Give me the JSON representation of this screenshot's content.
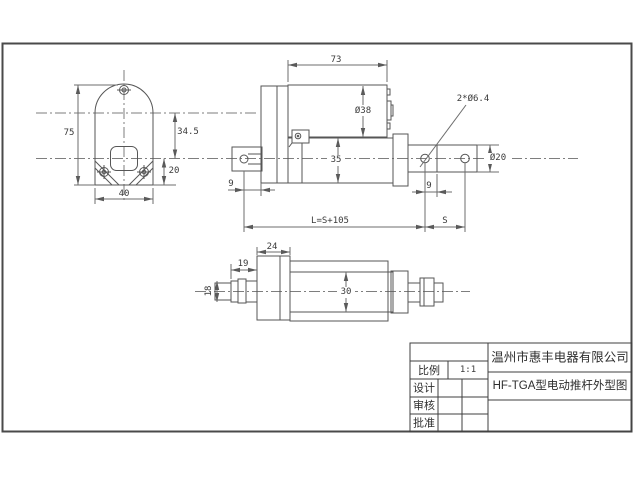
{
  "drawing": {
    "views": {
      "side_view": {
        "dims": {
          "overall_height": "75",
          "arc_center_to_axis": "34.5",
          "axis_to_bottom": "20",
          "width": "40"
        }
      },
      "front_view": {
        "dims": {
          "motor_length": "73",
          "motor_diameter": "Ø38",
          "tube_height": "35",
          "rear_pin_offset": "9",
          "rod_hole_offset": "9",
          "pin_holes": "2*Ø6.4",
          "rod_diameter": "Ø20",
          "mounting_length": "L=S+105",
          "stroke": "S"
        }
      },
      "bottom_view": {
        "dims": {
          "gear_housing_width": "24",
          "shaft_length": "19",
          "shaft_diameter": "18",
          "tube_diameter": "30"
        }
      }
    },
    "title_block": {
      "scale_label": "比例",
      "scale_value": "1:1",
      "design_label": "设计",
      "check_label": "审核",
      "approve_label": "批准",
      "company": "温州市惠丰电器有限公司",
      "drawing_title": "HF-TGA型电动推杆外型图"
    }
  }
}
